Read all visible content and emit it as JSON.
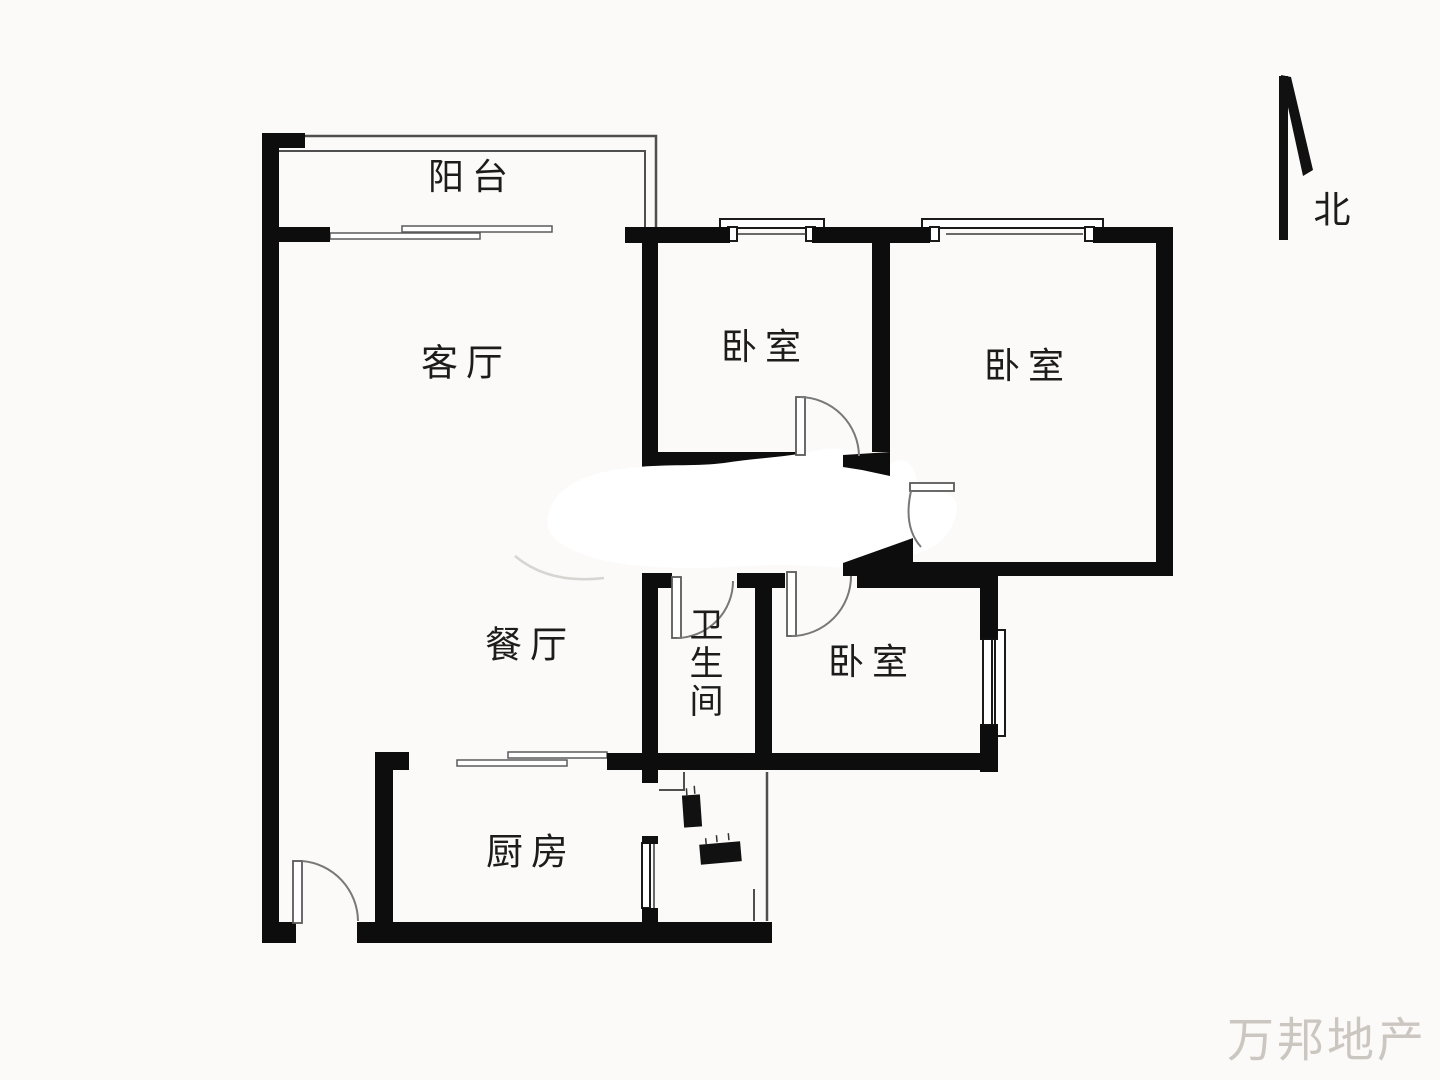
{
  "floorplan": {
    "rooms": {
      "balcony": {
        "label": "阳台"
      },
      "living_room": {
        "label": "客厅"
      },
      "dining_room": {
        "label": "餐厅"
      },
      "bedroom_north_left": {
        "label": "卧室"
      },
      "bedroom_north_right": {
        "label": "卧室"
      },
      "bedroom_east": {
        "label": "卧室"
      },
      "bathroom": {
        "label": "卫生间"
      },
      "kitchen": {
        "label": "厨房"
      }
    },
    "compass": {
      "label": "北"
    },
    "watermark": {
      "text": "万邦地产"
    },
    "colors": {
      "wall": "#0d0d0d",
      "thin_line": "#4f4f4f",
      "door_line": "#787878",
      "faint_line": "#d8d4d1",
      "label_text": "#1c1c1c",
      "watermark_text": "#ccc6c1",
      "background": "#fbfaf9"
    }
  }
}
